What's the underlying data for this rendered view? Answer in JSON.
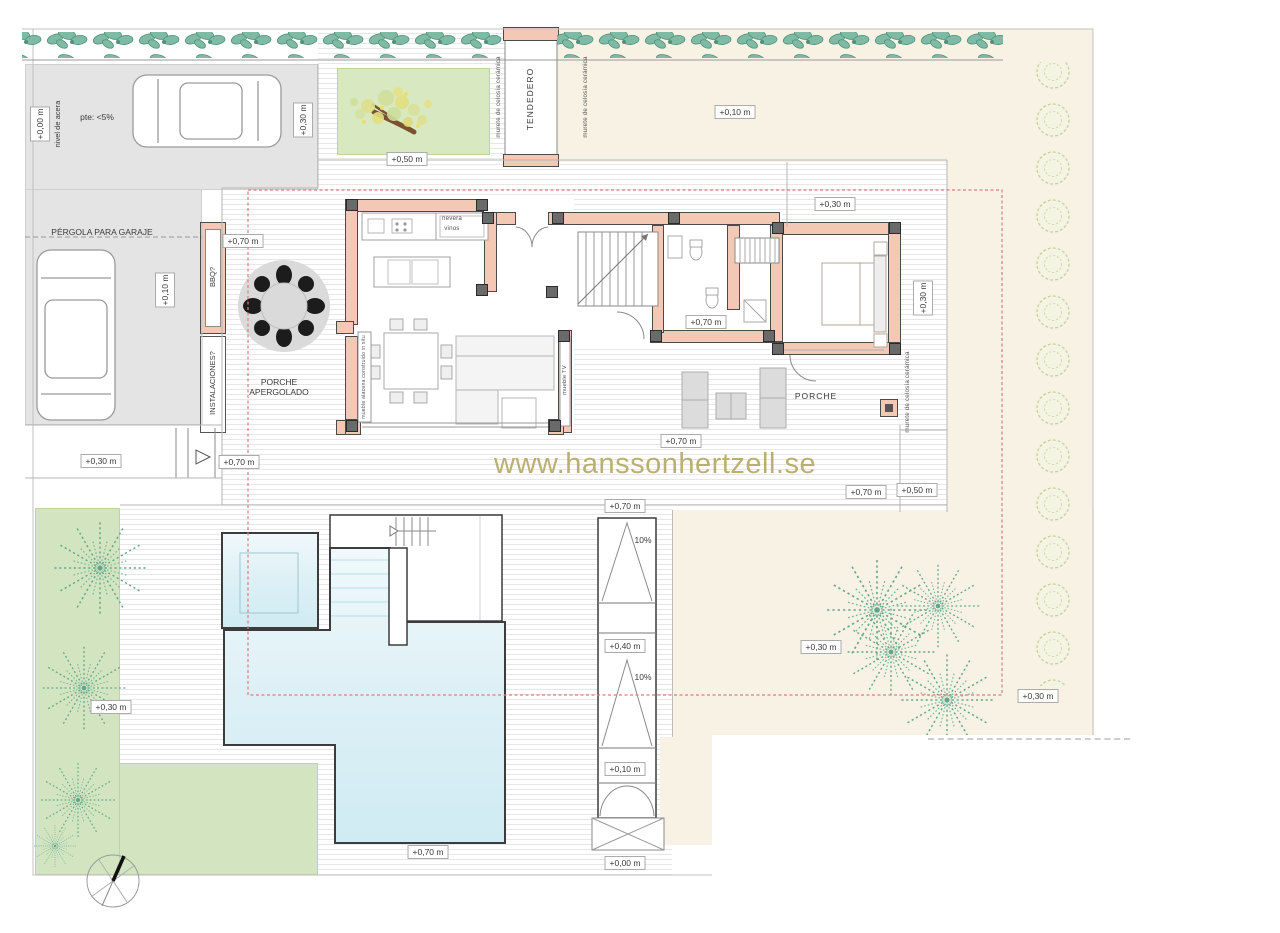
{
  "watermark": {
    "text": "www.hanssonhertzell.se"
  },
  "labels": {
    "pergola_garaje": "PÉRGOLA PARA GARAJE",
    "porche_apergolado": "PORCHE\nAPERGOLADO",
    "porche": "PORCHE",
    "tendedero": "TENDEDERO",
    "bbq": "BBQ?",
    "instalaciones": "INSTALACIONES?",
    "slope_note": "pte: <5%",
    "nivel_acera": "nivel de acera",
    "murete_celosia": "murete de celosía cerámica",
    "nevera_vinos": "nevera\nvinos",
    "mueble_tv": "mueble TV",
    "mueble_alacena": "mueble alacena construido in situ",
    "ramp_slope": "10%"
  },
  "levels": {
    "p000": "+0,00 m",
    "p010": "+0,10 m",
    "p030": "+0,30 m",
    "p040": "+0,40 m",
    "p050": "+0,50 m",
    "p070": "+0,70 m"
  },
  "colors": {
    "wall_pink": "#f3c9b6",
    "garage_gray": "#e4e4e4",
    "cream": "#f7f2e3",
    "lawn_green": "#d3e5c0",
    "pool_blue": "#d0ebf3",
    "hedge_green": "#7fbaa4",
    "palm_green": "#63a68d",
    "bush_olive": "#c6d29a",
    "setback_red": "#dc7c7c",
    "watermark_olive": "#b2a55f"
  }
}
